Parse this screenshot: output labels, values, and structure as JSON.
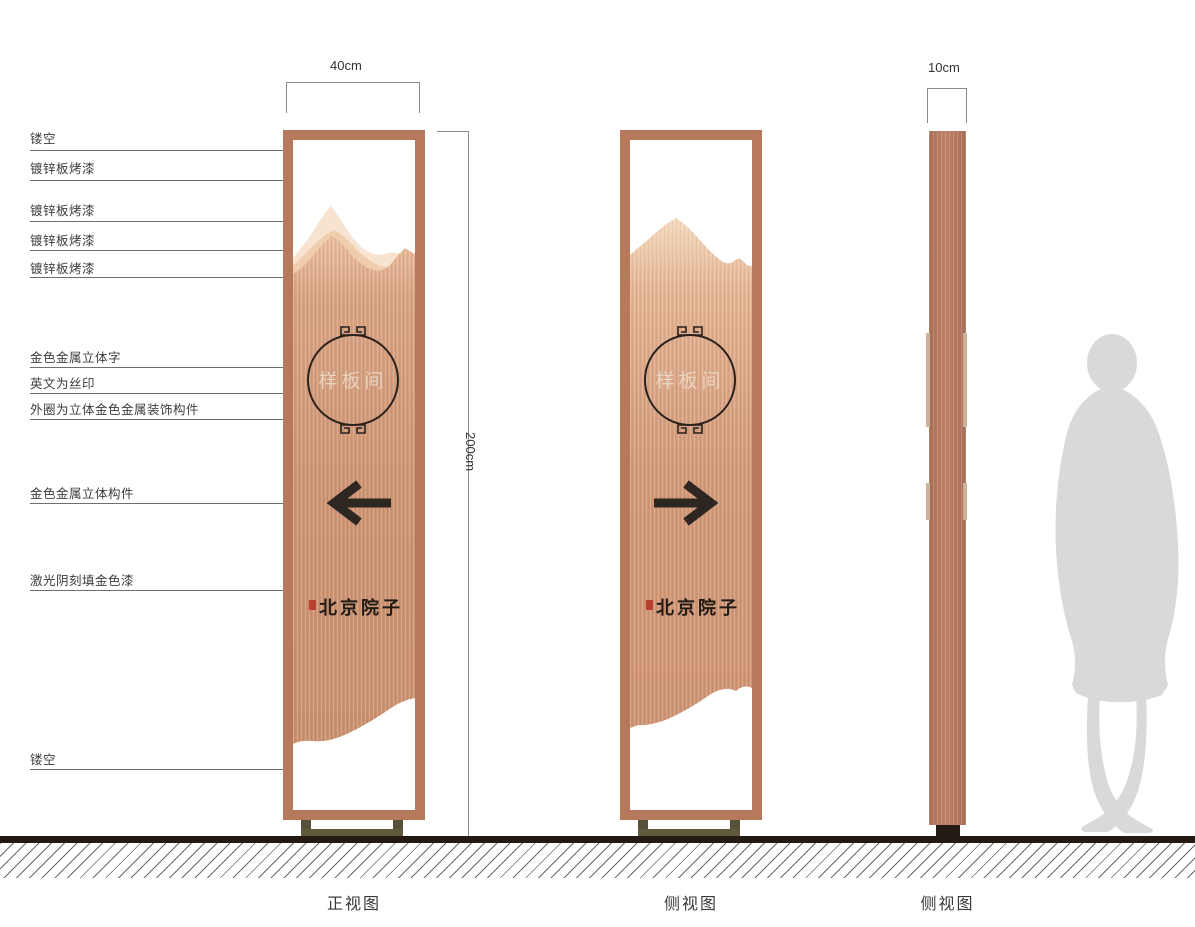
{
  "annotations": [
    {
      "label": "镂空"
    },
    {
      "label": "镀锌板烤漆"
    },
    {
      "label": "镀锌板烤漆"
    },
    {
      "label": "镀锌板烤漆"
    },
    {
      "label": "镀锌板烤漆"
    },
    {
      "label": "金色金属立体字"
    },
    {
      "label": "英文为丝印"
    },
    {
      "label": "外圈为立体金色金属装饰构件"
    },
    {
      "label": "金色金属立体构件"
    },
    {
      "label": "激光阴刻填金色漆"
    },
    {
      "label": "镂空"
    }
  ],
  "dimensions": {
    "front_width": "40cm",
    "height": "200cm",
    "side_depth": "10cm"
  },
  "views": {
    "front_caption": "正视图",
    "side_caption_1": "侧视图",
    "side_caption_2": "侧视图"
  },
  "sign": {
    "room_label": "样板间",
    "brand_name": "北京院子"
  },
  "icons": {
    "left_arrow": "left-arrow-icon",
    "right_arrow": "right-arrow-icon",
    "meander_ornament": "meander-ornament-icon",
    "red_seal": "red-seal-icon",
    "human_figure": "human-figure-silhouette"
  },
  "colors": {
    "frame_copper": "#b6795c",
    "panel_copper": "#cf9674",
    "mountain_light": "#f7e3cf",
    "base_olive": "#57513a",
    "glyph_dark": "#2e2620",
    "seal_red": "#b8402e",
    "silhouette_gray": "#d9d9d9"
  }
}
